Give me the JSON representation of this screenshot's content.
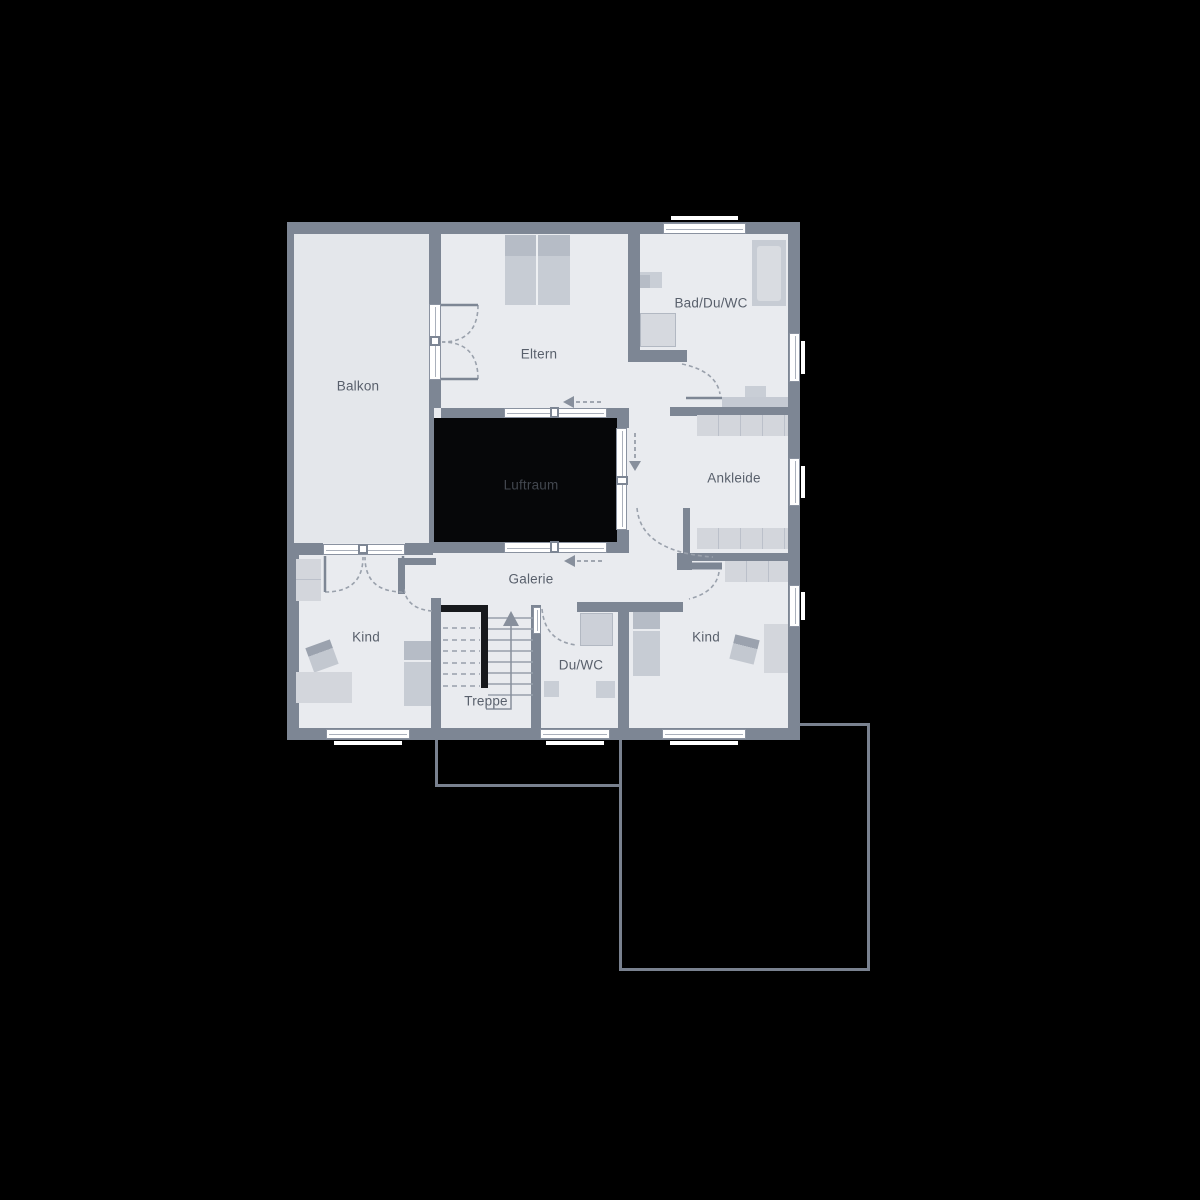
{
  "title": "Obergeschoss Grundriss",
  "rooms": {
    "balkon": {
      "label": "Balkon"
    },
    "eltern": {
      "label": "Eltern"
    },
    "bad": {
      "label": "Bad/Du/WC"
    },
    "ankleide": {
      "label": "Ankleide"
    },
    "luftraum": {
      "label": "Luftraum"
    },
    "galerie": {
      "label": "Galerie"
    },
    "kind_left": {
      "label": "Kind"
    },
    "kind_right": {
      "label": "Kind"
    },
    "treppe": {
      "label": "Treppe"
    },
    "duwc": {
      "label": "Du/WC"
    }
  },
  "palette": {
    "background": "#000000",
    "wall": "#7d8694",
    "room_fill": "#e9ebef",
    "balcony_fill": "#e4e7eb",
    "void_fill": "#060709",
    "window": "#ffffff",
    "furniture_light": "#d3d6dc",
    "furniture_mid": "#c7ccd4",
    "furniture_dark": "#b6bcc6",
    "label_text": "#59606c",
    "void_label_text": "#42474f",
    "door_arc": "#9aa1ac",
    "arrow": "#878f9c",
    "stair_rail": "#17191d",
    "ground_outline": "#79818f"
  },
  "symbols": {
    "stair_direction": "up",
    "circulation_arrow_count": 3,
    "window_count": 7,
    "door_count": 8
  }
}
